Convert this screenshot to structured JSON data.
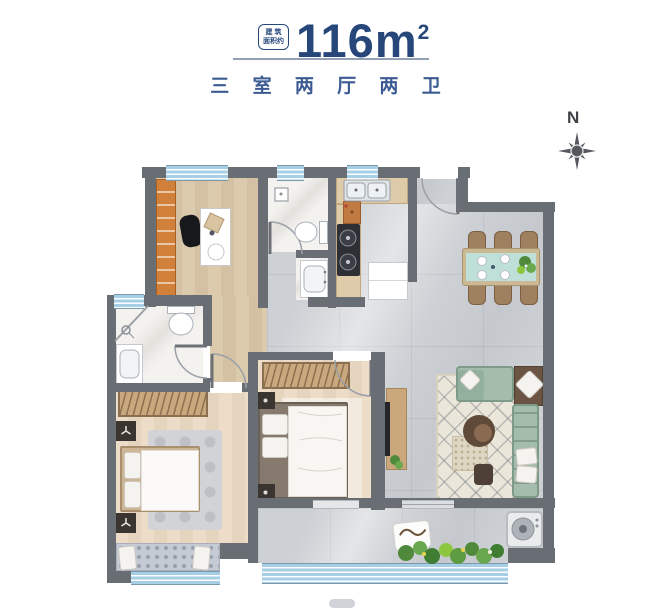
{
  "header": {
    "badge": {
      "line1": "建 筑",
      "line2": "面积约"
    },
    "area": {
      "value": "116",
      "unit": "m",
      "superscript": "2"
    },
    "subtitle": "三 室 两 厅 两 卫"
  },
  "compass": {
    "north_label": "N"
  },
  "colors": {
    "title": "#27477b",
    "subtitle": "#3c5b92",
    "wall": "#696d74",
    "window": "#a6cfe6",
    "sofa_green": "#a3bcab",
    "shelf_orange": "#d08038",
    "dining_table_teal": "#bfe0d9",
    "wood_floor": "#d8c5a8",
    "tile_floor": "#cdd0d4"
  }
}
